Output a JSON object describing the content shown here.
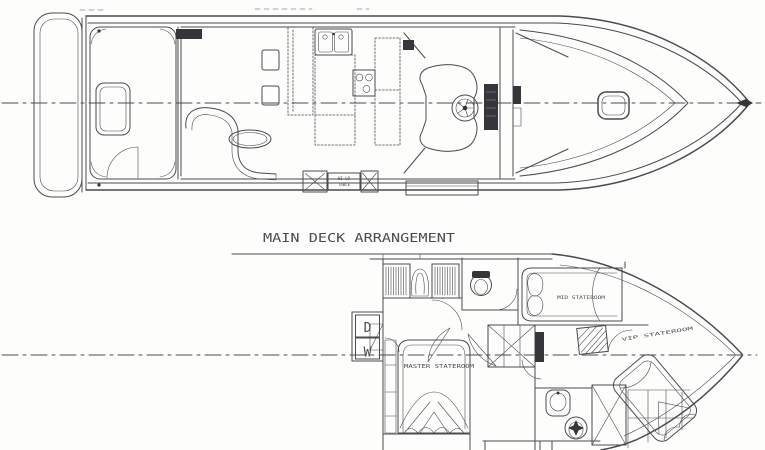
{
  "colors": {
    "background": "#fdfdfc",
    "ink": "#4b4b50",
    "ink_dark": "#35353a"
  },
  "drawing": {
    "title": "MAIN DECK ARRANGEMENT",
    "labels": {
      "master_stateroom": "MASTER STATEROOM",
      "mid_stateroom": "MID STATEROOM",
      "vip_stateroom": "VIP STATEROOM",
      "dryer": "D",
      "washer": "W",
      "hilo_line1": "HI-LO",
      "hilo_line2": "TABLE"
    }
  }
}
